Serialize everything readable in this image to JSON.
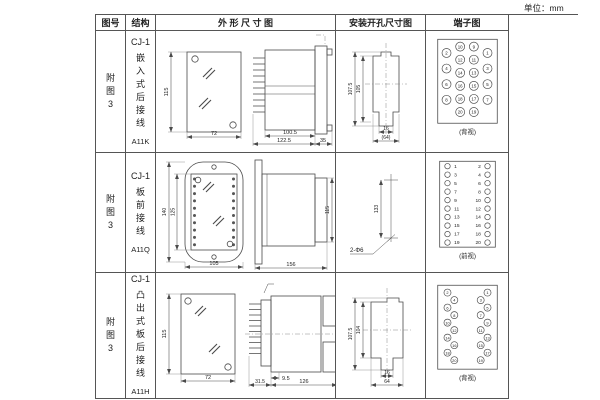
{
  "unit_label": "单位：mm",
  "table": {
    "headers": {
      "fig_no": "图号",
      "structure": "结构",
      "outline": "外 形 尺 寸 图",
      "install": "安装开孔尺寸图",
      "terminal": "端子图"
    },
    "rows": [
      {
        "fig_no_lines": [
          "附",
          "图",
          "3"
        ],
        "structure_lines": [
          "CJ-1",
          "嵌",
          "入",
          "式",
          "后",
          "接",
          "线",
          "A11K"
        ],
        "outline": {
          "front_height": "115",
          "front_width": "72",
          "body_depth": "100.5",
          "total_depth": "122.5",
          "flange_depth": "35"
        },
        "install": {
          "outer_height": "107.5",
          "inner_height": "105",
          "slot_width": "16",
          "total_width": "(64)"
        },
        "terminal": {
          "caption": "(背视)",
          "outer_left": [
            "2",
            "4",
            "6",
            "8"
          ],
          "mid_left": [
            "10",
            "12",
            "14",
            "16",
            "18",
            "20"
          ],
          "mid_right": [
            "9",
            "11",
            "13",
            "15",
            "17",
            "19"
          ],
          "outer_right": [
            "1",
            "3",
            "5",
            "7"
          ]
        }
      },
      {
        "fig_no_lines": [
          "附",
          "图",
          "3"
        ],
        "structure_lines": [
          "CJ-1",
          "板",
          "前",
          "接",
          "线",
          "A11Q"
        ],
        "outline": {
          "front_outer_height": "140",
          "front_inner_height": "125",
          "front_width": "105",
          "side_length": "156",
          "side_height": "115"
        },
        "install": {
          "hole_spacing": "133",
          "hole_spec": "2-Φ6"
        },
        "terminal": {
          "caption": "(前视)",
          "left": [
            "1",
            "3",
            "5",
            "7",
            "9",
            "11",
            "13",
            "15",
            "17",
            "19"
          ],
          "right": [
            "2",
            "4",
            "6",
            "8",
            "10",
            "12",
            "14",
            "16",
            "18",
            "20"
          ]
        }
      },
      {
        "fig_no_lines": [
          "附",
          "图",
          "3"
        ],
        "structure_lines": [
          "CJ-1",
          "凸",
          "出",
          "式",
          "板",
          "后",
          "接",
          "线",
          "A11H"
        ],
        "outline": {
          "front_height": "115",
          "front_width": "72",
          "fin_depth": "31.5",
          "lip_depth": "9.5",
          "side_length": "126"
        },
        "install": {
          "outer_height": "107.5",
          "inner_height": "104",
          "slot_width": "16",
          "total_width": "64"
        },
        "terminal": {
          "caption": "(背视)",
          "left": [
            "2",
            "4",
            "6",
            "8",
            "10",
            "12",
            "14",
            "16",
            "18",
            "20"
          ],
          "right": [
            "1",
            "3",
            "5",
            "7",
            "9",
            "11",
            "13",
            "15",
            "17",
            "19"
          ]
        }
      }
    ]
  }
}
